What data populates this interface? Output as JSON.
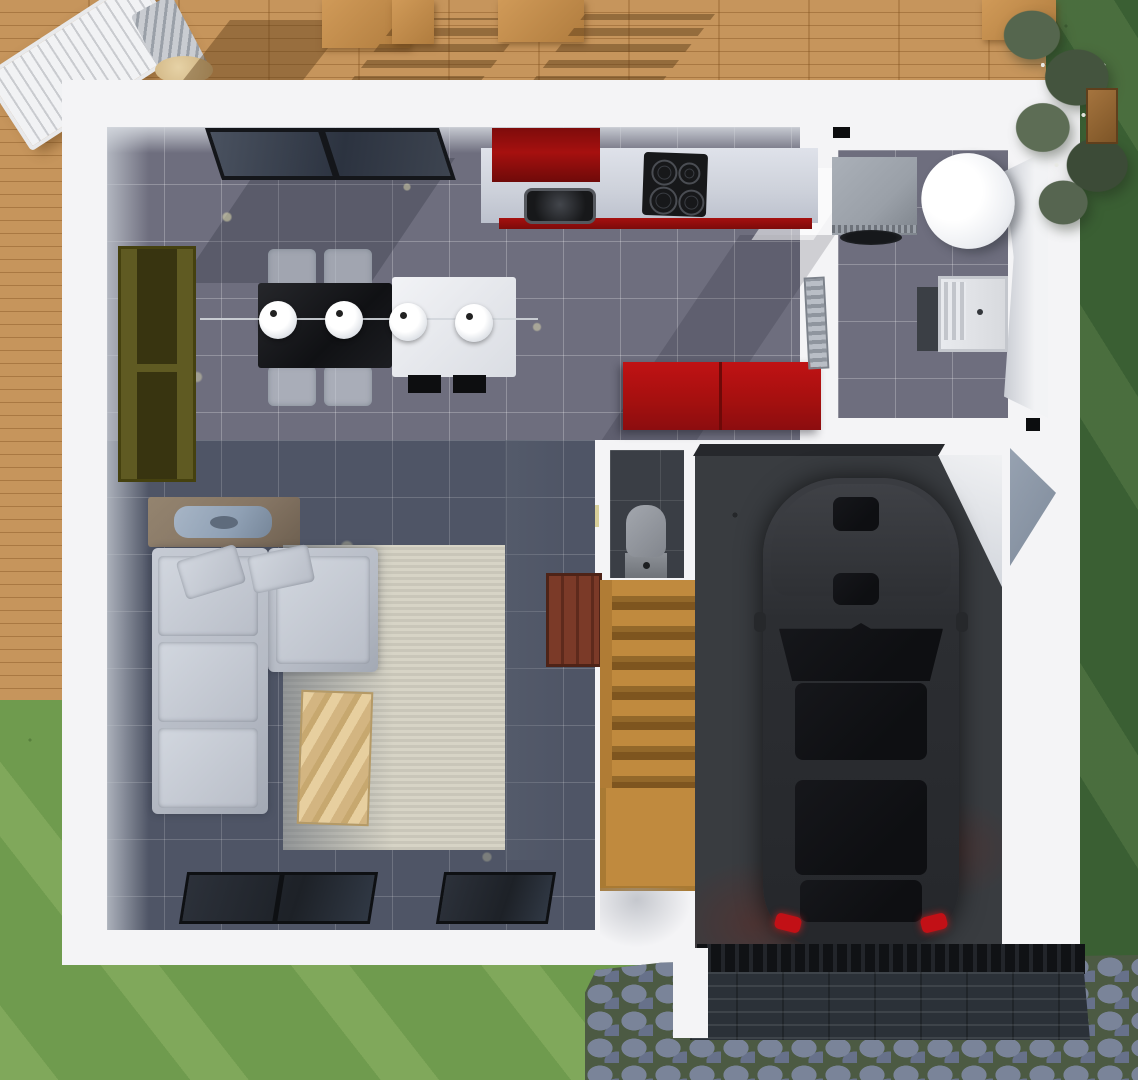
{
  "title": "3D top-down floor plan render",
  "colors": {
    "deck": "#c6955c",
    "grass": "#6f9b4e",
    "grassDark": "#3a5f33",
    "wall": "#f4f4f6",
    "wallShade": "#c3c8d0",
    "tileUpper": "#6e6e7e",
    "tileLower": "#4f5566",
    "charcoal": "#3a3e45",
    "counter": "#ced2db",
    "red": "#a6100f",
    "redDark": "#7c0b0a",
    "black": "#17181a",
    "olive": "#5f5a22",
    "oliveDark": "#383410",
    "sofa": "#b6bbc5",
    "rug": "#d7d4c6",
    "woodTable": "#ddc094",
    "rust": "#857564",
    "glassBlue": "#8fa0b4",
    "stairWood": "#c08a3e",
    "stairDark": "#7e551f",
    "mahogany": "#7b3a28",
    "toiletGray": "#8f939b",
    "washer": "#9aa0a8",
    "drum": "#34373c",
    "heater": "#eceef2",
    "concrete": "#393c40",
    "carBody": "#2c2e32",
    "carGlass": "#0e0f12",
    "tailRed": "#c21016",
    "cobble": "#7a8499",
    "cobbleAlt": "#67718a",
    "cobbleJoint": "#4c5a43",
    "slate": "#2b3138",
    "slateLine": "#3c444c"
  },
  "scene": {
    "view": "top-down",
    "areas": [
      "wooden-deck",
      "garden-grass",
      "cobblestone-driveway"
    ],
    "rooms": [
      "kitchen-dining",
      "living-room",
      "utility-room",
      "wc",
      "stairwell",
      "garage"
    ],
    "kitchen": {
      "burner_count": 4,
      "pendant_lamp_count": 4,
      "units_color_name": "red"
    },
    "dining": {
      "tables": [
        "black",
        "white"
      ],
      "ghost_chairs": 4,
      "black_chairs": 2
    },
    "living": {
      "furniture": [
        "l-shaped-sofa",
        "throw-pillows",
        "rug",
        "coffee-table",
        "olive-shelf",
        "rust-console"
      ]
    },
    "utility": {
      "appliances": [
        "washing-machine",
        "water-heater",
        "laundry-sink"
      ]
    },
    "stairs": {
      "straight_treads": 7,
      "winder_treads": 4,
      "material": "wood"
    },
    "garage": {
      "vehicle": "black-car",
      "taillights": 2,
      "floor": "concrete"
    },
    "outdoor": {
      "deck_furniture": [
        "lounge-chair",
        "wood-table-and-chairs",
        "side-table",
        "bench"
      ],
      "hedge": "flowering-shrubs"
    }
  }
}
